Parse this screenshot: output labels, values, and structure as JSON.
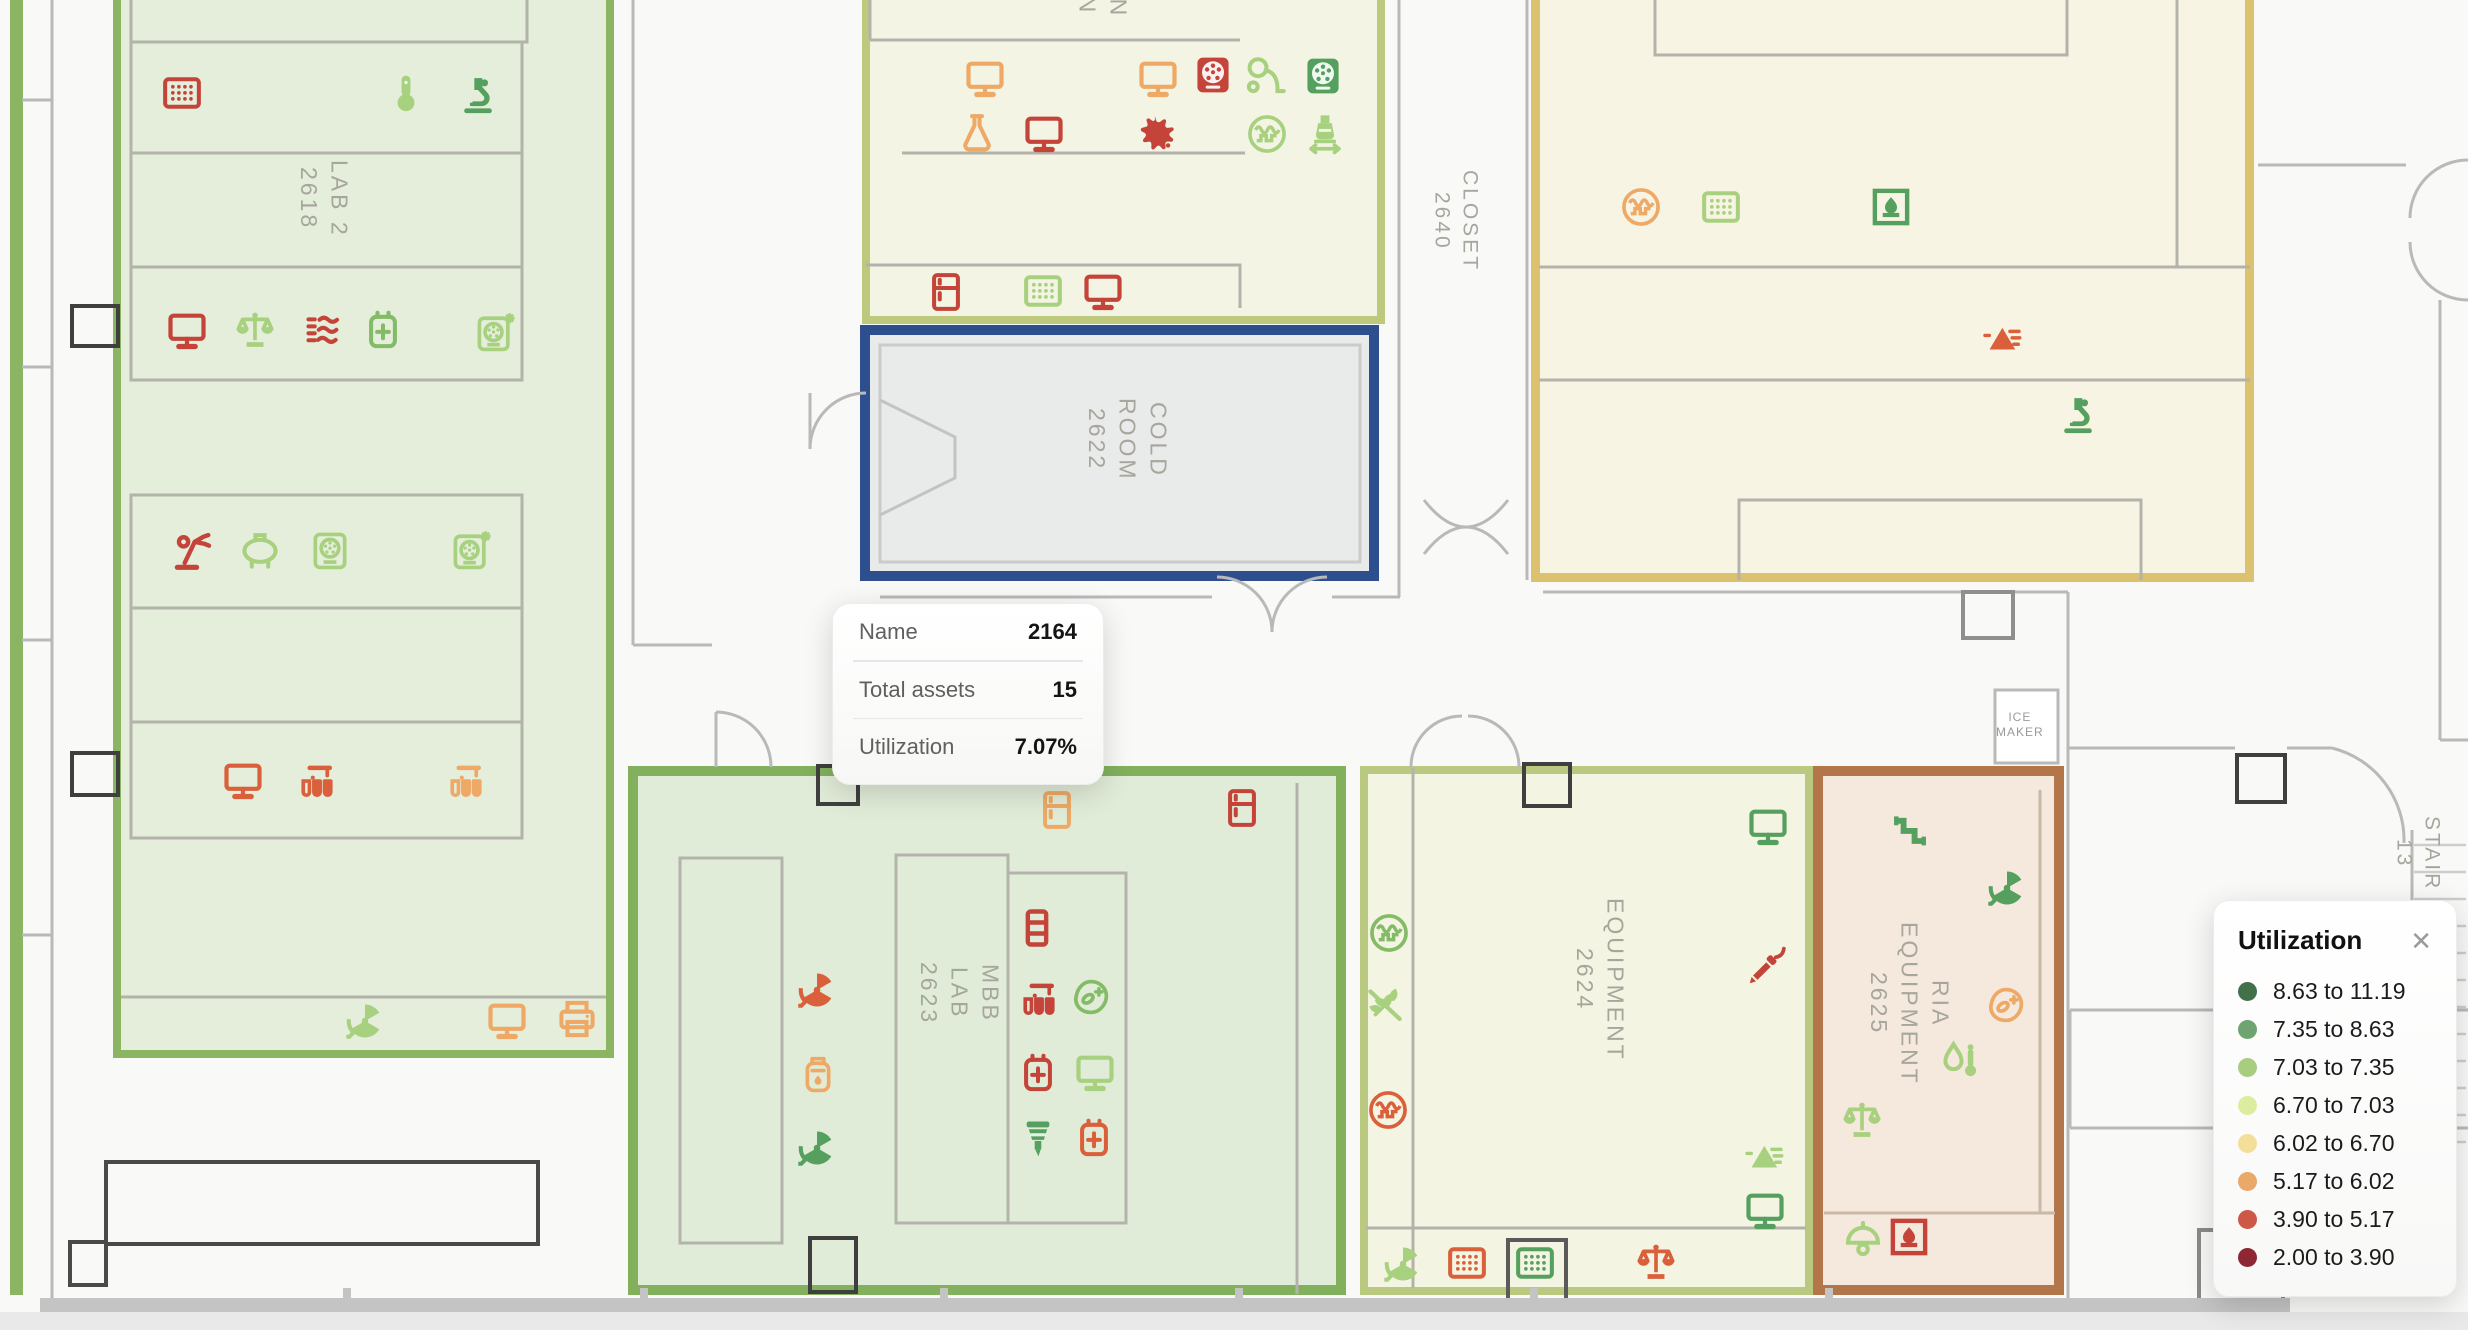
{
  "tooltip": {
    "rows": [
      {
        "label": "Name",
        "value": "2164"
      },
      {
        "label": "Total assets",
        "value": "15"
      },
      {
        "label": "Utilization",
        "value": "7.07%"
      }
    ]
  },
  "legend": {
    "title": "Utilization",
    "close_icon": "✕",
    "items": [
      {
        "color": "#41704b",
        "label": "8.63 to 11.19"
      },
      {
        "color": "#6da46f",
        "label": "7.35 to 8.63"
      },
      {
        "color": "#a8cd7f",
        "label": "7.03 to 7.35"
      },
      {
        "color": "#dded9f",
        "label": "6.70 to 7.03"
      },
      {
        "color": "#f3df99",
        "label": "6.02 to 6.70"
      },
      {
        "color": "#eaa869",
        "label": "5.17 to 6.02"
      },
      {
        "color": "#cd5847",
        "label": "3.90 to 5.17"
      },
      {
        "color": "#8e2733",
        "label": "2.00 to 3.90"
      }
    ]
  },
  "map": {
    "rooms": [
      {
        "id": "edge-room",
        "lines": [],
        "x": 10,
        "y": -10,
        "w": 13,
        "h": 1305,
        "fill": "#8cb563",
        "border": "#8cb563",
        "bw": 0,
        "lx": 0,
        "ly": 0
      },
      {
        "id": "lab-2618",
        "lines": [
          "LAB 2",
          "2618"
        ],
        "x": 113,
        "y": -20,
        "w": 501,
        "h": 1078,
        "fill": "#e4eedb",
        "border": "#8cb563",
        "bw": 8,
        "lx": 292,
        "ly": 160
      },
      {
        "id": "protein-station-2621",
        "lines": [
          "PROTEIN",
          "STATION",
          "2621"
        ],
        "x": 862,
        "y": -24,
        "w": 523,
        "h": 348,
        "fill": "#f3f4e3",
        "border": "#bdca7d",
        "bw": 8,
        "lx": 1040,
        "ly": -105
      },
      {
        "id": "cold-room-2622",
        "lines": [
          "COLD",
          "ROOM",
          "2622"
        ],
        "x": 860,
        "y": 325,
        "w": 519,
        "h": 256,
        "fill": "#e9eaea",
        "border": "#2d4f8e",
        "bw": 10,
        "lx": 1080,
        "ly": 398
      },
      {
        "id": "room-2640-east",
        "lines": [],
        "x": 1531,
        "y": -24,
        "w": 723,
        "h": 606,
        "fill": "#f8f4e4",
        "border": "#dcc26e",
        "bw": 9,
        "lx": 0,
        "ly": 0
      },
      {
        "id": "mbb-lab-2623",
        "lines": [
          "MBB",
          "LAB",
          "2623"
        ],
        "x": 628,
        "y": 766,
        "w": 718,
        "h": 529,
        "fill": "#e1ecd8",
        "border": "#82b05c",
        "bw": 10,
        "lx": 912,
        "ly": 962
      },
      {
        "id": "equipment-2624",
        "lines": [
          "EQUIPMENT",
          "2624"
        ],
        "x": 1360,
        "y": 766,
        "w": 453,
        "h": 529,
        "fill": "#f3f4e1",
        "border": "#b9c97f",
        "bw": 8,
        "lx": 1568,
        "ly": 898
      },
      {
        "id": "ria-equipment-2625",
        "lines": [
          "RIA",
          "EQUIPMENT",
          "2625"
        ],
        "x": 1813,
        "y": 766,
        "w": 251,
        "h": 529,
        "fill": "#f5e8dc",
        "border": "#b3754a",
        "bw": 10,
        "lx": 1862,
        "ly": 922
      }
    ],
    "area_labels": [
      {
        "id": "closet-2640",
        "lines": [
          "CLOSET",
          "2640"
        ],
        "x": 1426,
        "y": 170,
        "vertical": true
      },
      {
        "id": "stair-13",
        "lines": [
          "STAIR",
          "13"
        ],
        "x": 2388,
        "y": 816,
        "vertical": true
      },
      {
        "id": "ice-maker",
        "lines": [
          "ICE",
          "MAKER"
        ],
        "x": 1996,
        "y": 710,
        "vertical": false
      }
    ],
    "icons": [
      {
        "type": "microplate",
        "color": "#c4443a",
        "x": 160,
        "y": 71
      },
      {
        "type": "thermometer",
        "color": "#a8d17f",
        "x": 384,
        "y": 71
      },
      {
        "type": "microscope",
        "color": "#55a05e",
        "x": 456,
        "y": 73
      },
      {
        "type": "monitor",
        "color": "#c4443a",
        "x": 165,
        "y": 308
      },
      {
        "type": "balance",
        "color": "#a8d17f",
        "x": 233,
        "y": 308
      },
      {
        "type": "heat-exchanger",
        "color": "#c4443a",
        "x": 303,
        "y": 308
      },
      {
        "type": "charger",
        "color": "#83bb66",
        "x": 361,
        "y": 308
      },
      {
        "type": "refrigerated-centrifuge",
        "color": "#a8d17f",
        "x": 473,
        "y": 310
      },
      {
        "type": "robot-arm",
        "color": "#c4443a",
        "x": 170,
        "y": 529
      },
      {
        "type": "tank",
        "color": "#a8d17f",
        "x": 238,
        "y": 528
      },
      {
        "type": "centrifuge",
        "color": "#a8d17f",
        "x": 308,
        "y": 528
      },
      {
        "type": "refrigerated-centrifuge",
        "color": "#a8d17f",
        "x": 449,
        "y": 528
      },
      {
        "type": "monitor",
        "color": "#d9603b",
        "x": 221,
        "y": 758
      },
      {
        "type": "test-tubes",
        "color": "#d9603b",
        "x": 295,
        "y": 760
      },
      {
        "type": "test-tubes",
        "color": "#eda965",
        "x": 444,
        "y": 760
      },
      {
        "type": "radiation-fan",
        "color": "#a8d17f",
        "x": 343,
        "y": 999
      },
      {
        "type": "monitor",
        "color": "#eda965",
        "x": 485,
        "y": 998
      },
      {
        "type": "printer",
        "color": "#eda965",
        "x": 555,
        "y": 997
      },
      {
        "type": "monitor",
        "color": "#eda965",
        "x": 963,
        "y": 56
      },
      {
        "type": "monitor",
        "color": "#eda965",
        "x": 1136,
        "y": 56
      },
      {
        "type": "centrifuge-front",
        "color": "#c4443a",
        "x": 1191,
        "y": 53
      },
      {
        "type": "vacuum-pump",
        "color": "#a8d17f",
        "x": 1243,
        "y": 53
      },
      {
        "type": "centrifuge-front",
        "color": "#55a05e",
        "x": 1301,
        "y": 54
      },
      {
        "type": "flask",
        "color": "#eda965",
        "x": 955,
        "y": 111
      },
      {
        "type": "monitor",
        "color": "#c4443a",
        "x": 1022,
        "y": 111
      },
      {
        "type": "splat",
        "color": "#c4443a",
        "x": 1134,
        "y": 111
      },
      {
        "type": "oscilloscope",
        "color": "#a8d17f",
        "x": 1245,
        "y": 112
      },
      {
        "type": "flask-transfer",
        "color": "#a8d17f",
        "x": 1303,
        "y": 111
      },
      {
        "type": "fridge",
        "color": "#c4443a",
        "x": 924,
        "y": 270
      },
      {
        "type": "microplate",
        "color": "#a8d17f",
        "x": 1021,
        "y": 269
      },
      {
        "type": "monitor",
        "color": "#c4443a",
        "x": 1081,
        "y": 269
      },
      {
        "type": "oscilloscope",
        "color": "#eda965",
        "x": 1619,
        "y": 185
      },
      {
        "type": "microplate",
        "color": "#a8d17f",
        "x": 1699,
        "y": 185
      },
      {
        "type": "incubator",
        "color": "#55a05e",
        "x": 1869,
        "y": 185
      },
      {
        "type": "analyzer",
        "color": "#d9603b",
        "x": 1980,
        "y": 315
      },
      {
        "type": "microscope",
        "color": "#55a05e",
        "x": 2056,
        "y": 393
      },
      {
        "type": "fridge",
        "color": "#eda965",
        "x": 1035,
        "y": 788
      },
      {
        "type": "fridge",
        "color": "#c4443a",
        "x": 1220,
        "y": 786
      },
      {
        "type": "tube-rack",
        "color": "#c4443a",
        "x": 1015,
        "y": 906
      },
      {
        "type": "test-tubes",
        "color": "#c4443a",
        "x": 1017,
        "y": 978
      },
      {
        "type": "cell-counter",
        "color": "#83bb66",
        "x": 1069,
        "y": 975
      },
      {
        "type": "charger",
        "color": "#c4443a",
        "x": 1016,
        "y": 1051
      },
      {
        "type": "monitor",
        "color": "#a8d17f",
        "x": 1073,
        "y": 1050
      },
      {
        "type": "pipette-tip",
        "color": "#55a05e",
        "x": 1016,
        "y": 1116
      },
      {
        "type": "charger",
        "color": "#d9603b",
        "x": 1072,
        "y": 1116
      },
      {
        "type": "radiation-fan",
        "color": "#d9603b",
        "x": 795,
        "y": 968
      },
      {
        "type": "reagent-canister",
        "color": "#eda965",
        "x": 796,
        "y": 1053
      },
      {
        "type": "radiation-fan",
        "color": "#55a05e",
        "x": 795,
        "y": 1126
      },
      {
        "type": "monitor",
        "color": "#55a05e",
        "x": 1746,
        "y": 804
      },
      {
        "type": "oscilloscope",
        "color": "#83bb66",
        "x": 1367,
        "y": 911
      },
      {
        "type": "wheat-off",
        "color": "#a8d17f",
        "x": 1363,
        "y": 983
      },
      {
        "type": "oscilloscope",
        "color": "#d9603b",
        "x": 1366,
        "y": 1088
      },
      {
        "type": "soldering-pen",
        "color": "#c4443a",
        "x": 1745,
        "y": 944
      },
      {
        "type": "analyzer",
        "color": "#a8d17f",
        "x": 1742,
        "y": 1133
      },
      {
        "type": "monitor",
        "color": "#55a05e",
        "x": 1743,
        "y": 1188
      },
      {
        "type": "radiation-fan",
        "color": "#a8d17f",
        "x": 1381,
        "y": 1242
      },
      {
        "type": "microplate",
        "color": "#d9603b",
        "x": 1445,
        "y": 1241
      },
      {
        "type": "microplate",
        "color": "#55a05e",
        "x": 1513,
        "y": 1241
      },
      {
        "type": "balance",
        "color": "#d9603b",
        "x": 1634,
        "y": 1240
      },
      {
        "type": "pipeline",
        "color": "#55a05e",
        "x": 1888,
        "y": 808
      },
      {
        "type": "radiation-fan",
        "color": "#55a05e",
        "x": 1985,
        "y": 866
      },
      {
        "type": "cell-counter",
        "color": "#eda965",
        "x": 1984,
        "y": 983
      },
      {
        "type": "drop-thermometer",
        "color": "#a8d17f",
        "x": 1937,
        "y": 1038
      },
      {
        "type": "balance",
        "color": "#a8d17f",
        "x": 1840,
        "y": 1098
      },
      {
        "type": "lamp-dome",
        "color": "#a8d17f",
        "x": 1841,
        "y": 1216
      },
      {
        "type": "incubator",
        "color": "#c4443a",
        "x": 1887,
        "y": 1215
      }
    ]
  },
  "geometry": {
    "tooltip": {
      "x": 832,
      "y": 603,
      "w": 270,
      "h": 180
    },
    "legend": {
      "x": 2213,
      "y": 900,
      "w": 244,
      "h": 382
    }
  }
}
